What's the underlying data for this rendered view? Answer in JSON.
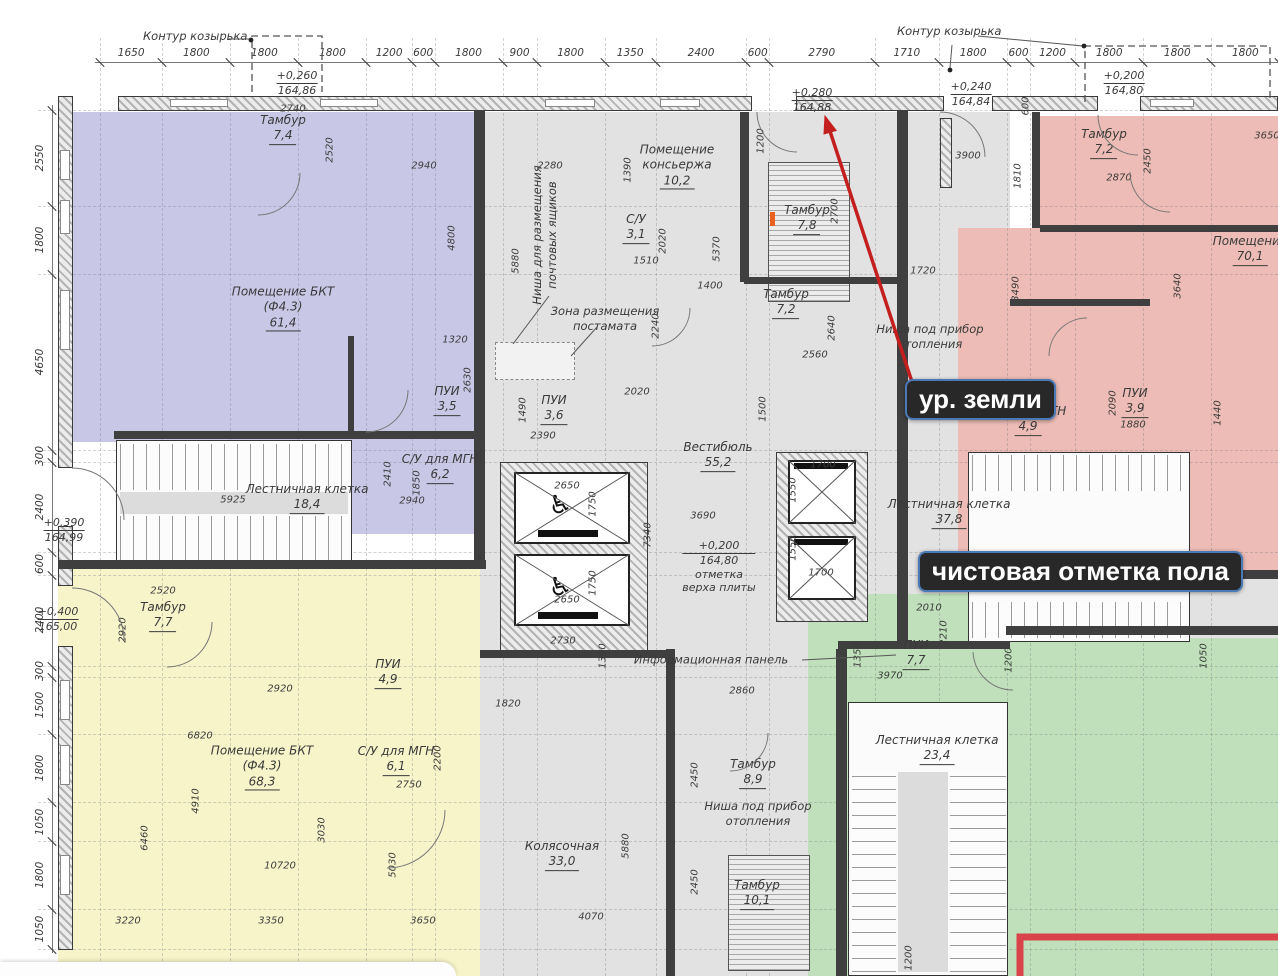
{
  "meta": {
    "width": 1278,
    "height": 976,
    "drawing_type": "floor-plan"
  },
  "colors": {
    "purple": "#c9c7e6",
    "gray": "#e2e2e2",
    "yellow": "#f7f4ca",
    "pink": "#edbcb6",
    "green": "#bfe0ba",
    "red_arrow": "#c41f1f",
    "red_rect": "#d9434a",
    "badge_bg": "#282828",
    "badge_border": "#4a7ab5",
    "badge_text": "#ffffff"
  },
  "annotations": {
    "canopy_left": "Контур козырька",
    "canopy_right": "Контур козырька",
    "ground_level": "ур. земли",
    "floor_level": "чистовая отметка пола"
  },
  "top_dims": {
    "values": [
      "1650",
      "1800",
      "1800",
      "1800",
      "1200",
      "600",
      "1800",
      "900",
      "1800",
      "1350",
      "2400",
      "600",
      "2790",
      "1710",
      "1800",
      "600",
      "1200",
      "1800",
      "1800",
      "1800"
    ]
  },
  "left_dims": {
    "values": [
      "2550",
      "1800",
      "4650",
      "300",
      "2400",
      "600",
      "2400",
      "300",
      "1500",
      "1800",
      "1050",
      "1800",
      "1050"
    ]
  },
  "elevations": [
    {
      "top": "+0,260",
      "bot": "164,86",
      "x": 297,
      "y": 69,
      "extra": []
    },
    {
      "top": "+0,280",
      "bot": "164,88",
      "x": 812,
      "y": 86,
      "extra": []
    },
    {
      "top": "+0,240",
      "bot": "164,84",
      "x": 971,
      "y": 80,
      "extra": []
    },
    {
      "top": "+0,200",
      "bot": "164,80",
      "x": 1124,
      "y": 69,
      "extra": []
    },
    {
      "top": "+0,390",
      "bot": "164,99",
      "x": 64,
      "y": 516,
      "extra": []
    },
    {
      "top": "+0,400",
      "bot": "165,00",
      "x": 58,
      "y": 605,
      "extra": []
    },
    {
      "top": "+0,200",
      "bot": "164,80",
      "x": 719,
      "y": 539,
      "extra": [
        "отметка",
        "верха плиты"
      ]
    }
  ],
  "rooms": [
    {
      "lines": [
        "Тамбур"
      ],
      "area": "7,4",
      "x": 283,
      "y": 129
    },
    {
      "lines": [
        "Помещение БКТ",
        "(Ф4.3)"
      ],
      "area": "61,4",
      "x": 283,
      "y": 308
    },
    {
      "lines": [
        "ПУИ"
      ],
      "area": "3,5",
      "x": 447,
      "y": 400
    },
    {
      "lines": [
        "С/У для МГН"
      ],
      "area": "6,2",
      "x": 440,
      "y": 468
    },
    {
      "lines": [
        "Лестничная клетка"
      ],
      "area": "18,4",
      "x": 307,
      "y": 498
    },
    {
      "lines": [
        "Тамбур"
      ],
      "area": "7,7",
      "x": 163,
      "y": 616
    },
    {
      "lines": [
        "Помещение БКТ",
        "(Ф4.3)"
      ],
      "area": "68,3",
      "x": 262,
      "y": 767
    },
    {
      "lines": [
        "ПУИ"
      ],
      "area": "4,9",
      "x": 388,
      "y": 673
    },
    {
      "lines": [
        "С/У для МГН"
      ],
      "area": "6,1",
      "x": 396,
      "y": 760
    },
    {
      "lines": [
        "Помещение",
        "консьержа"
      ],
      "area": "10,2",
      "x": 677,
      "y": 166
    },
    {
      "lines": [
        "С/У"
      ],
      "area": "3,1",
      "x": 636,
      "y": 228
    },
    {
      "lines": [
        "ПУИ"
      ],
      "area": "3,6",
      "x": 554,
      "y": 409
    },
    {
      "lines": [
        "Тамбур"
      ],
      "area": "7,8",
      "x": 807,
      "y": 219
    },
    {
      "lines": [
        "Тамбур"
      ],
      "area": "7,2",
      "x": 786,
      "y": 303
    },
    {
      "lines": [
        "Вестибюль"
      ],
      "area": "55,2",
      "x": 718,
      "y": 456
    },
    {
      "lines": [
        "Тамбур"
      ],
      "area": "8,9",
      "x": 753,
      "y": 773
    },
    {
      "lines": [
        "Колясочная"
      ],
      "area": "33,0",
      "x": 562,
      "y": 855
    },
    {
      "lines": [
        "Тамбур"
      ],
      "area": "10,1",
      "x": 757,
      "y": 894
    },
    {
      "lines": [
        "Лестничная клетка"
      ],
      "area": "23,4",
      "x": 937,
      "y": 749
    },
    {
      "lines": [
        "ПУИ"
      ],
      "area": "7,7",
      "x": 916,
      "y": 654
    },
    {
      "lines": [
        "Тамбур"
      ],
      "area": "7,2",
      "x": 1104,
      "y": 143
    },
    {
      "lines": [
        "Помещение"
      ],
      "area": "70,1",
      "x": 1250,
      "y": 250
    },
    {
      "lines": [
        "ПУИ"
      ],
      "area": "3,9",
      "x": 1135,
      "y": 402
    },
    {
      "lines": [
        "С/У для МГН"
      ],
      "area": "4,9",
      "x": 1028,
      "y": 420
    },
    {
      "lines": [
        "Лестничная клетка"
      ],
      "area": "37,8",
      "x": 949,
      "y": 513
    }
  ],
  "notes": [
    {
      "lines": [
        "Ниша для размещения",
        "почтовых ящиков"
      ],
      "x": 545,
      "y": 235,
      "rot": 1
    },
    {
      "lines": [
        "Зона размещения",
        "постамата"
      ],
      "x": 605,
      "y": 319,
      "rot": 0
    },
    {
      "lines": [
        "Информационная панель"
      ],
      "x": 711,
      "y": 660,
      "rot": 0
    },
    {
      "lines": [
        "Ниша под прибор",
        "отопления"
      ],
      "x": 758,
      "y": 814,
      "rot": 0
    },
    {
      "lines": [
        "Ниша под прибор",
        "отопления"
      ],
      "x": 930,
      "y": 337,
      "rot": 0
    }
  ],
  "dim_labels": [
    {
      "t": "2740",
      "x": 293,
      "y": 109,
      "r": 0
    },
    {
      "t": "2520",
      "x": 330,
      "y": 150,
      "r": 1
    },
    {
      "t": "2940",
      "x": 424,
      "y": 166,
      "r": 0
    },
    {
      "t": "4800",
      "x": 452,
      "y": 238,
      "r": 1
    },
    {
      "t": "1320",
      "x": 455,
      "y": 340,
      "r": 0
    },
    {
      "t": "2630",
      "x": 468,
      "y": 380,
      "r": 1
    },
    {
      "t": "2410",
      "x": 388,
      "y": 474,
      "r": 1
    },
    {
      "t": "1850",
      "x": 417,
      "y": 483,
      "r": 1
    },
    {
      "t": "2940",
      "x": 412,
      "y": 501,
      "r": 0
    },
    {
      "t": "5925",
      "x": 233,
      "y": 500,
      "r": 0
    },
    {
      "t": "2520",
      "x": 163,
      "y": 591,
      "r": 0
    },
    {
      "t": "2920",
      "x": 123,
      "y": 630,
      "r": 1
    },
    {
      "t": "2920",
      "x": 280,
      "y": 689,
      "r": 0
    },
    {
      "t": "6820",
      "x": 200,
      "y": 736,
      "r": 0
    },
    {
      "t": "4910",
      "x": 196,
      "y": 801,
      "r": 1
    },
    {
      "t": "6460",
      "x": 145,
      "y": 838,
      "r": 1
    },
    {
      "t": "10720",
      "x": 280,
      "y": 866,
      "r": 0
    },
    {
      "t": "3220",
      "x": 128,
      "y": 921,
      "r": 0
    },
    {
      "t": "3350",
      "x": 271,
      "y": 921,
      "r": 0
    },
    {
      "t": "3650",
      "x": 423,
      "y": 921,
      "r": 0
    },
    {
      "t": "2200",
      "x": 438,
      "y": 758,
      "r": 1
    },
    {
      "t": "2750",
      "x": 409,
      "y": 785,
      "r": 0
    },
    {
      "t": "3030",
      "x": 322,
      "y": 830,
      "r": 1
    },
    {
      "t": "5030",
      "x": 393,
      "y": 865,
      "r": 1
    },
    {
      "t": "5880",
      "x": 516,
      "y": 261,
      "r": 1
    },
    {
      "t": "2280",
      "x": 550,
      "y": 166,
      "r": 0
    },
    {
      "t": "1390",
      "x": 628,
      "y": 170,
      "r": 1
    },
    {
      "t": "1510",
      "x": 646,
      "y": 261,
      "r": 0
    },
    {
      "t": "2020",
      "x": 663,
      "y": 241,
      "r": 1
    },
    {
      "t": "5370",
      "x": 717,
      "y": 249,
      "r": 1
    },
    {
      "t": "1400",
      "x": 710,
      "y": 286,
      "r": 0
    },
    {
      "t": "2240",
      "x": 656,
      "y": 326,
      "r": 1
    },
    {
      "t": "2020",
      "x": 637,
      "y": 392,
      "r": 0
    },
    {
      "t": "1490",
      "x": 523,
      "y": 410,
      "r": 1
    },
    {
      "t": "2390",
      "x": 543,
      "y": 436,
      "r": 0
    },
    {
      "t": "1200",
      "x": 761,
      "y": 141,
      "r": 1
    },
    {
      "t": "2700",
      "x": 835,
      "y": 211,
      "r": 1
    },
    {
      "t": "2640",
      "x": 832,
      "y": 328,
      "r": 1
    },
    {
      "t": "2560",
      "x": 815,
      "y": 355,
      "r": 0
    },
    {
      "t": "1500",
      "x": 763,
      "y": 409,
      "r": 1
    },
    {
      "t": "3690",
      "x": 703,
      "y": 516,
      "r": 0
    },
    {
      "t": "7340",
      "x": 648,
      "y": 535,
      "r": 1
    },
    {
      "t": "2730",
      "x": 563,
      "y": 641,
      "r": 0
    },
    {
      "t": "1350",
      "x": 603,
      "y": 656,
      "r": 1
    },
    {
      "t": "1820",
      "x": 508,
      "y": 704,
      "r": 0
    },
    {
      "t": "2860",
      "x": 742,
      "y": 691,
      "r": 0
    },
    {
      "t": "2450",
      "x": 695,
      "y": 775,
      "r": 1
    },
    {
      "t": "5880",
      "x": 626,
      "y": 846,
      "r": 1
    },
    {
      "t": "4070",
      "x": 591,
      "y": 917,
      "r": 0
    },
    {
      "t": "2450",
      "x": 695,
      "y": 882,
      "r": 1
    },
    {
      "t": "1200",
      "x": 909,
      "y": 958,
      "r": 1
    },
    {
      "t": "2010",
      "x": 929,
      "y": 608,
      "r": 0
    },
    {
      "t": "2210",
      "x": 944,
      "y": 633,
      "r": 1
    },
    {
      "t": "1350",
      "x": 858,
      "y": 655,
      "r": 1
    },
    {
      "t": "3970",
      "x": 890,
      "y": 676,
      "r": 0
    },
    {
      "t": "1200",
      "x": 1009,
      "y": 660,
      "r": 1
    },
    {
      "t": "1050",
      "x": 1204,
      "y": 656,
      "r": 1
    },
    {
      "t": "1720",
      "x": 923,
      "y": 271,
      "r": 0
    },
    {
      "t": "3490",
      "x": 1016,
      "y": 289,
      "r": 1
    },
    {
      "t": "3640",
      "x": 1178,
      "y": 286,
      "r": 1
    },
    {
      "t": "11070",
      "x": 902,
      "y": 353,
      "r": 1
    },
    {
      "t": "3900",
      "x": 968,
      "y": 156,
      "r": 0
    },
    {
      "t": "1810",
      "x": 1018,
      "y": 176,
      "r": 1
    },
    {
      "t": "600",
      "x": 1026,
      "y": 106,
      "r": 1
    },
    {
      "t": "2870",
      "x": 1119,
      "y": 178,
      "r": 0
    },
    {
      "t": "2450",
      "x": 1148,
      "y": 161,
      "r": 1
    },
    {
      "t": "3650",
      "x": 1267,
      "y": 136,
      "r": 0
    },
    {
      "t": "2090",
      "x": 1113,
      "y": 403,
      "r": 1
    },
    {
      "t": "1880",
      "x": 1133,
      "y": 425,
      "r": 0
    },
    {
      "t": "1440",
      "x": 1218,
      "y": 413,
      "r": 1
    },
    {
      "t": "1700",
      "x": 823,
      "y": 465,
      "r": 0
    },
    {
      "t": "1550",
      "x": 793,
      "y": 490,
      "r": 1
    },
    {
      "t": "1550",
      "x": 793,
      "y": 548,
      "r": 1
    },
    {
      "t": "1700",
      "x": 821,
      "y": 573,
      "r": 0
    },
    {
      "t": "2650",
      "x": 567,
      "y": 486,
      "r": 0
    },
    {
      "t": "1750",
      "x": 593,
      "y": 504,
      "r": 1
    },
    {
      "t": "1750",
      "x": 593,
      "y": 583,
      "r": 1
    },
    {
      "t": "2650",
      "x": 567,
      "y": 600,
      "r": 0
    }
  ]
}
